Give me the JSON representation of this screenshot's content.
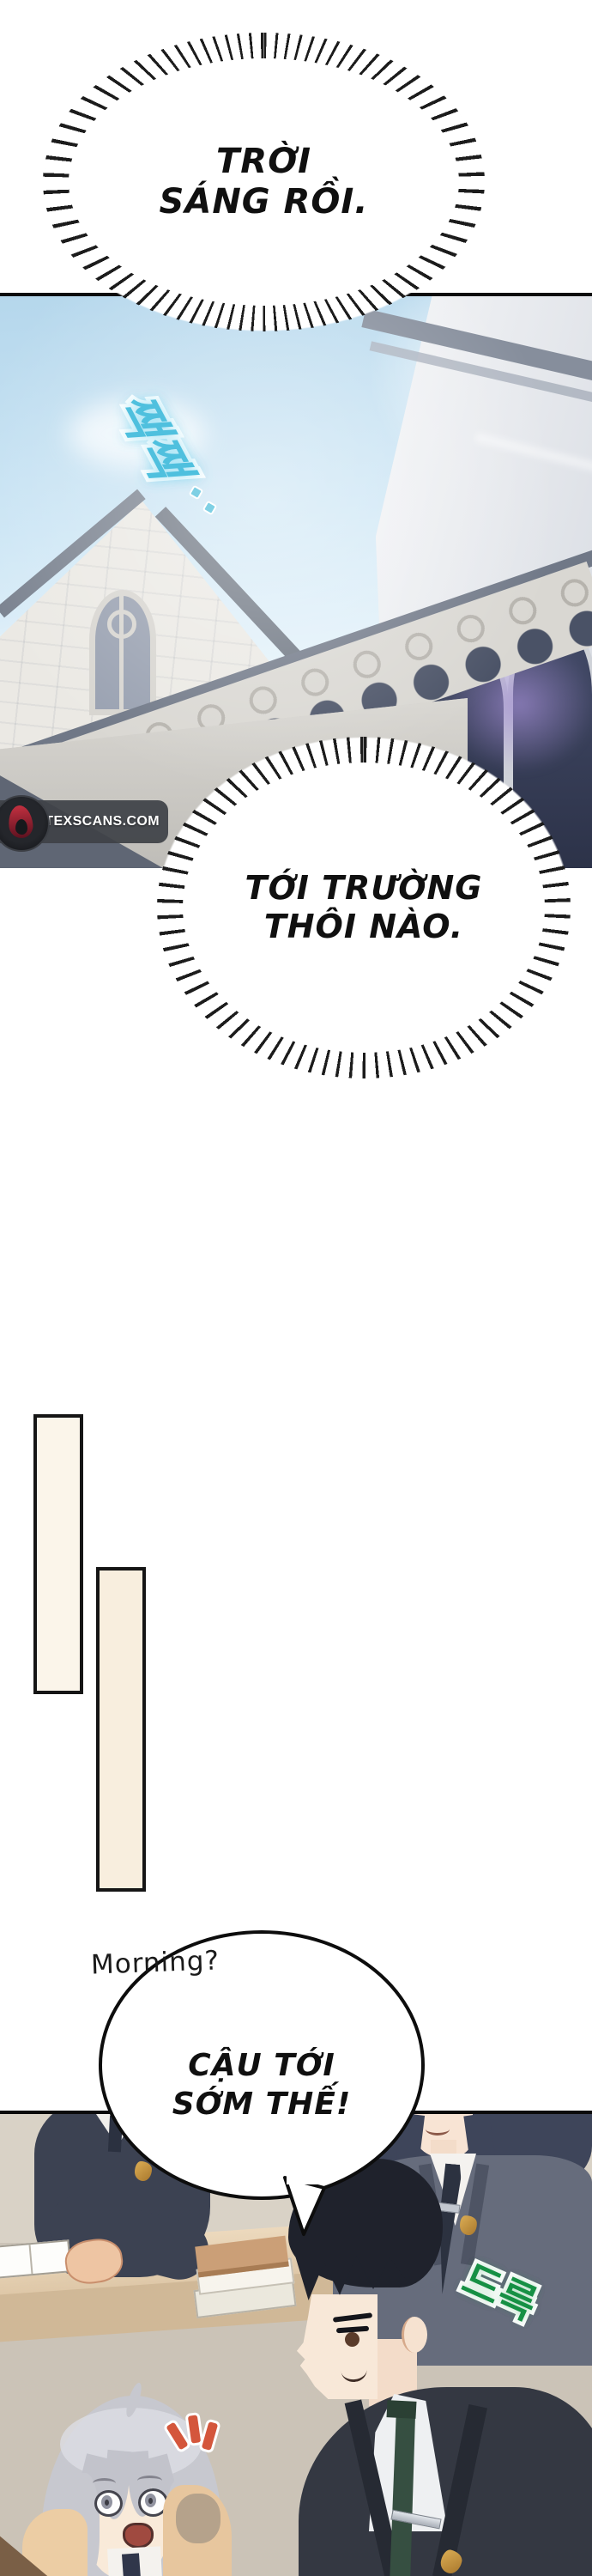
{
  "page_type": "manhwa-comic-page",
  "bubbles": {
    "burst_top": {
      "line1": "TRỜI",
      "line2": "SÁNG RỒI."
    },
    "burst_mid": {
      "line1": "TỚI TRƯỜNG",
      "line2": "THÔI NÀO."
    },
    "speech_bottom": {
      "line1": "CẬU TỚI",
      "line2": "SỚM THẾ!"
    }
  },
  "handwritten": {
    "morning": "Morning?"
  },
  "sfx": {
    "chirp": {
      "text": "짹짹",
      "color": "#4fc0de"
    },
    "slide": {
      "text": "드륵",
      "color": "#169044"
    }
  },
  "watermark": {
    "text": "VORTEXSCANS.COM"
  },
  "colors": {
    "sky": "#cde6f5",
    "stone_building": "#ebe9e4",
    "dark_window_flare": "#9a86c8",
    "rect_fill_1": "#fbf5ea",
    "rect_fill_2": "#f8eede",
    "classroom_wall": "#cbc3b7",
    "desk_wood": "#e3ceb2",
    "blazer_navy": "#3c4252",
    "blazer_grey": "#666c7c",
    "blazer_dark": "#343842",
    "tie_green": "#364f41",
    "hair_black": "#1f222c",
    "hair_navy": "#3e455a",
    "hair_silver": "#c7c8cf",
    "skin": "#f8e6d5",
    "emblem_gold": "#c89b3f",
    "emphasis_orange": "#d4563c"
  }
}
